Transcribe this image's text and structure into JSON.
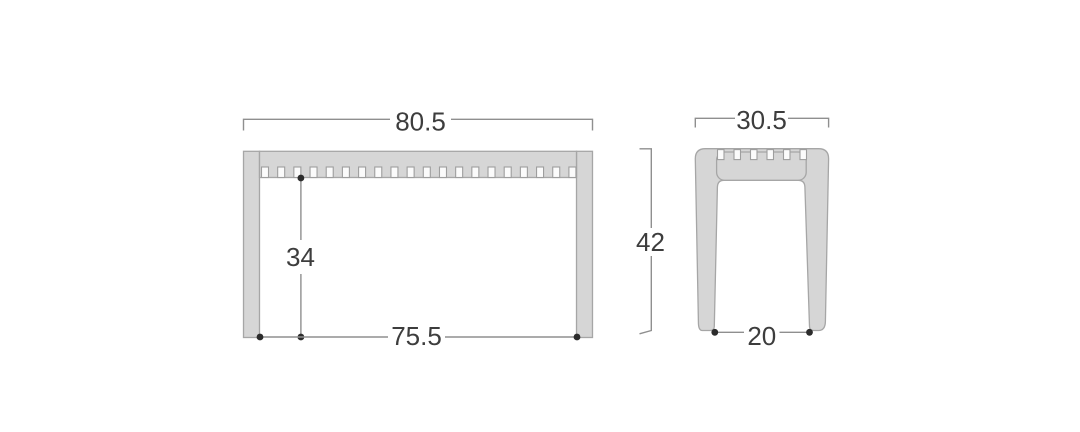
{
  "diagram": {
    "front": {
      "width": "80.5",
      "inner_height": "34",
      "inner_width": "75.5",
      "slat_count": 20
    },
    "side": {
      "depth": "30.5",
      "height": "42",
      "inner_width": "20",
      "slat_count": 6
    },
    "colors": {
      "background": "#ffffff",
      "part_fill": "#d6d6d6",
      "part_stroke": "#a6a6a6",
      "notch_fill": "#fbfbfb",
      "notch_stroke": "#9e9e9e",
      "dim_line": "#8f8f8f",
      "dim_text": "#3d3d3d",
      "dot": "#2c2c2c"
    }
  }
}
